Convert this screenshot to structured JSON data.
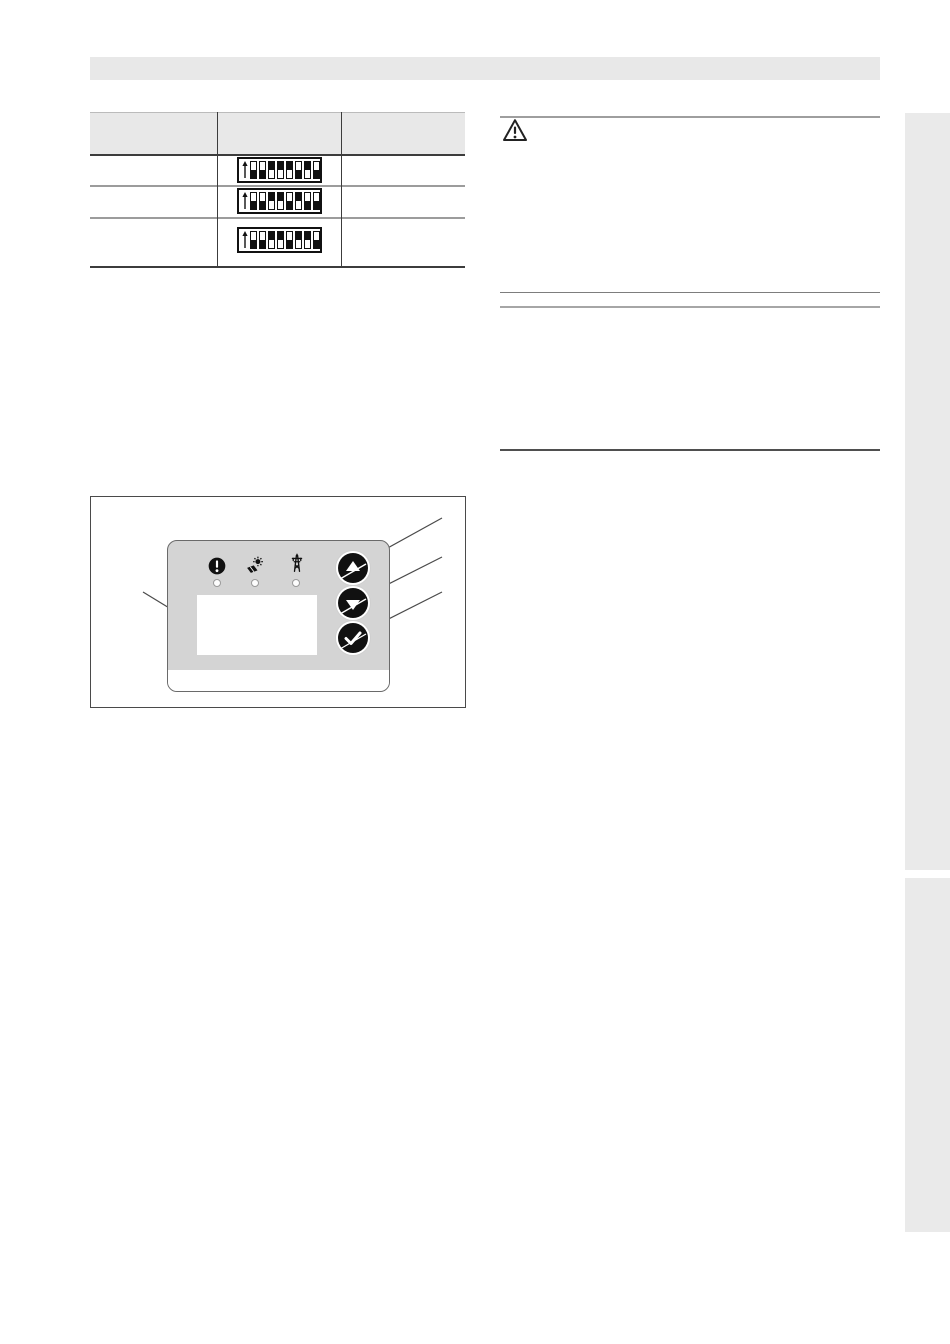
{
  "page": {
    "kind": "installation-manual-page",
    "background": "#ffffff"
  },
  "title_band": {
    "text": ""
  },
  "table": {
    "columns": [
      {
        "label": ""
      },
      {
        "label": ""
      },
      {
        "label": ""
      }
    ],
    "rows": [
      {
        "col1": "",
        "col3": "",
        "dip": {
          "arrow": "up",
          "positions": 8,
          "pattern": [
            "down",
            "down",
            "up",
            "up",
            "up",
            "down",
            "up",
            "down"
          ]
        }
      },
      {
        "col1": "",
        "col3": "",
        "dip": {
          "arrow": "up",
          "positions": 8,
          "pattern": [
            "down",
            "down",
            "up",
            "up",
            "down",
            "up",
            "down",
            "down"
          ]
        }
      },
      {
        "col1": "",
        "col3": "",
        "dip": {
          "arrow": "up",
          "positions": 8,
          "pattern": [
            "down",
            "down",
            "up",
            "up",
            "down",
            "up",
            "up",
            "down"
          ]
        }
      }
    ]
  },
  "warning_block": {
    "icon": "warning-triangle-icon",
    "text": ""
  },
  "figure": {
    "caption": "",
    "panel": {
      "status_icons": [
        {
          "name": "fault-icon",
          "led": "off"
        },
        {
          "name": "solar-icon",
          "led": "off"
        },
        {
          "name": "grid-icon",
          "led": "off"
        }
      ],
      "display": {
        "value": ""
      },
      "buttons": [
        {
          "name": "up-button",
          "glyph": "arrow-up"
        },
        {
          "name": "down-button",
          "glyph": "arrow-down"
        },
        {
          "name": "confirm-button",
          "glyph": "check"
        }
      ],
      "callouts": 4
    }
  },
  "colors": {
    "band_gray": "#e8e8e8",
    "table_header_gray": "#e8e8e8",
    "separator_gray": "#9c9c9c",
    "line_dark": "#3c3c3c",
    "panel_gray": "#d4d4d4",
    "switch_black": "#111111",
    "sidebar_gray": "#eaeaea"
  }
}
